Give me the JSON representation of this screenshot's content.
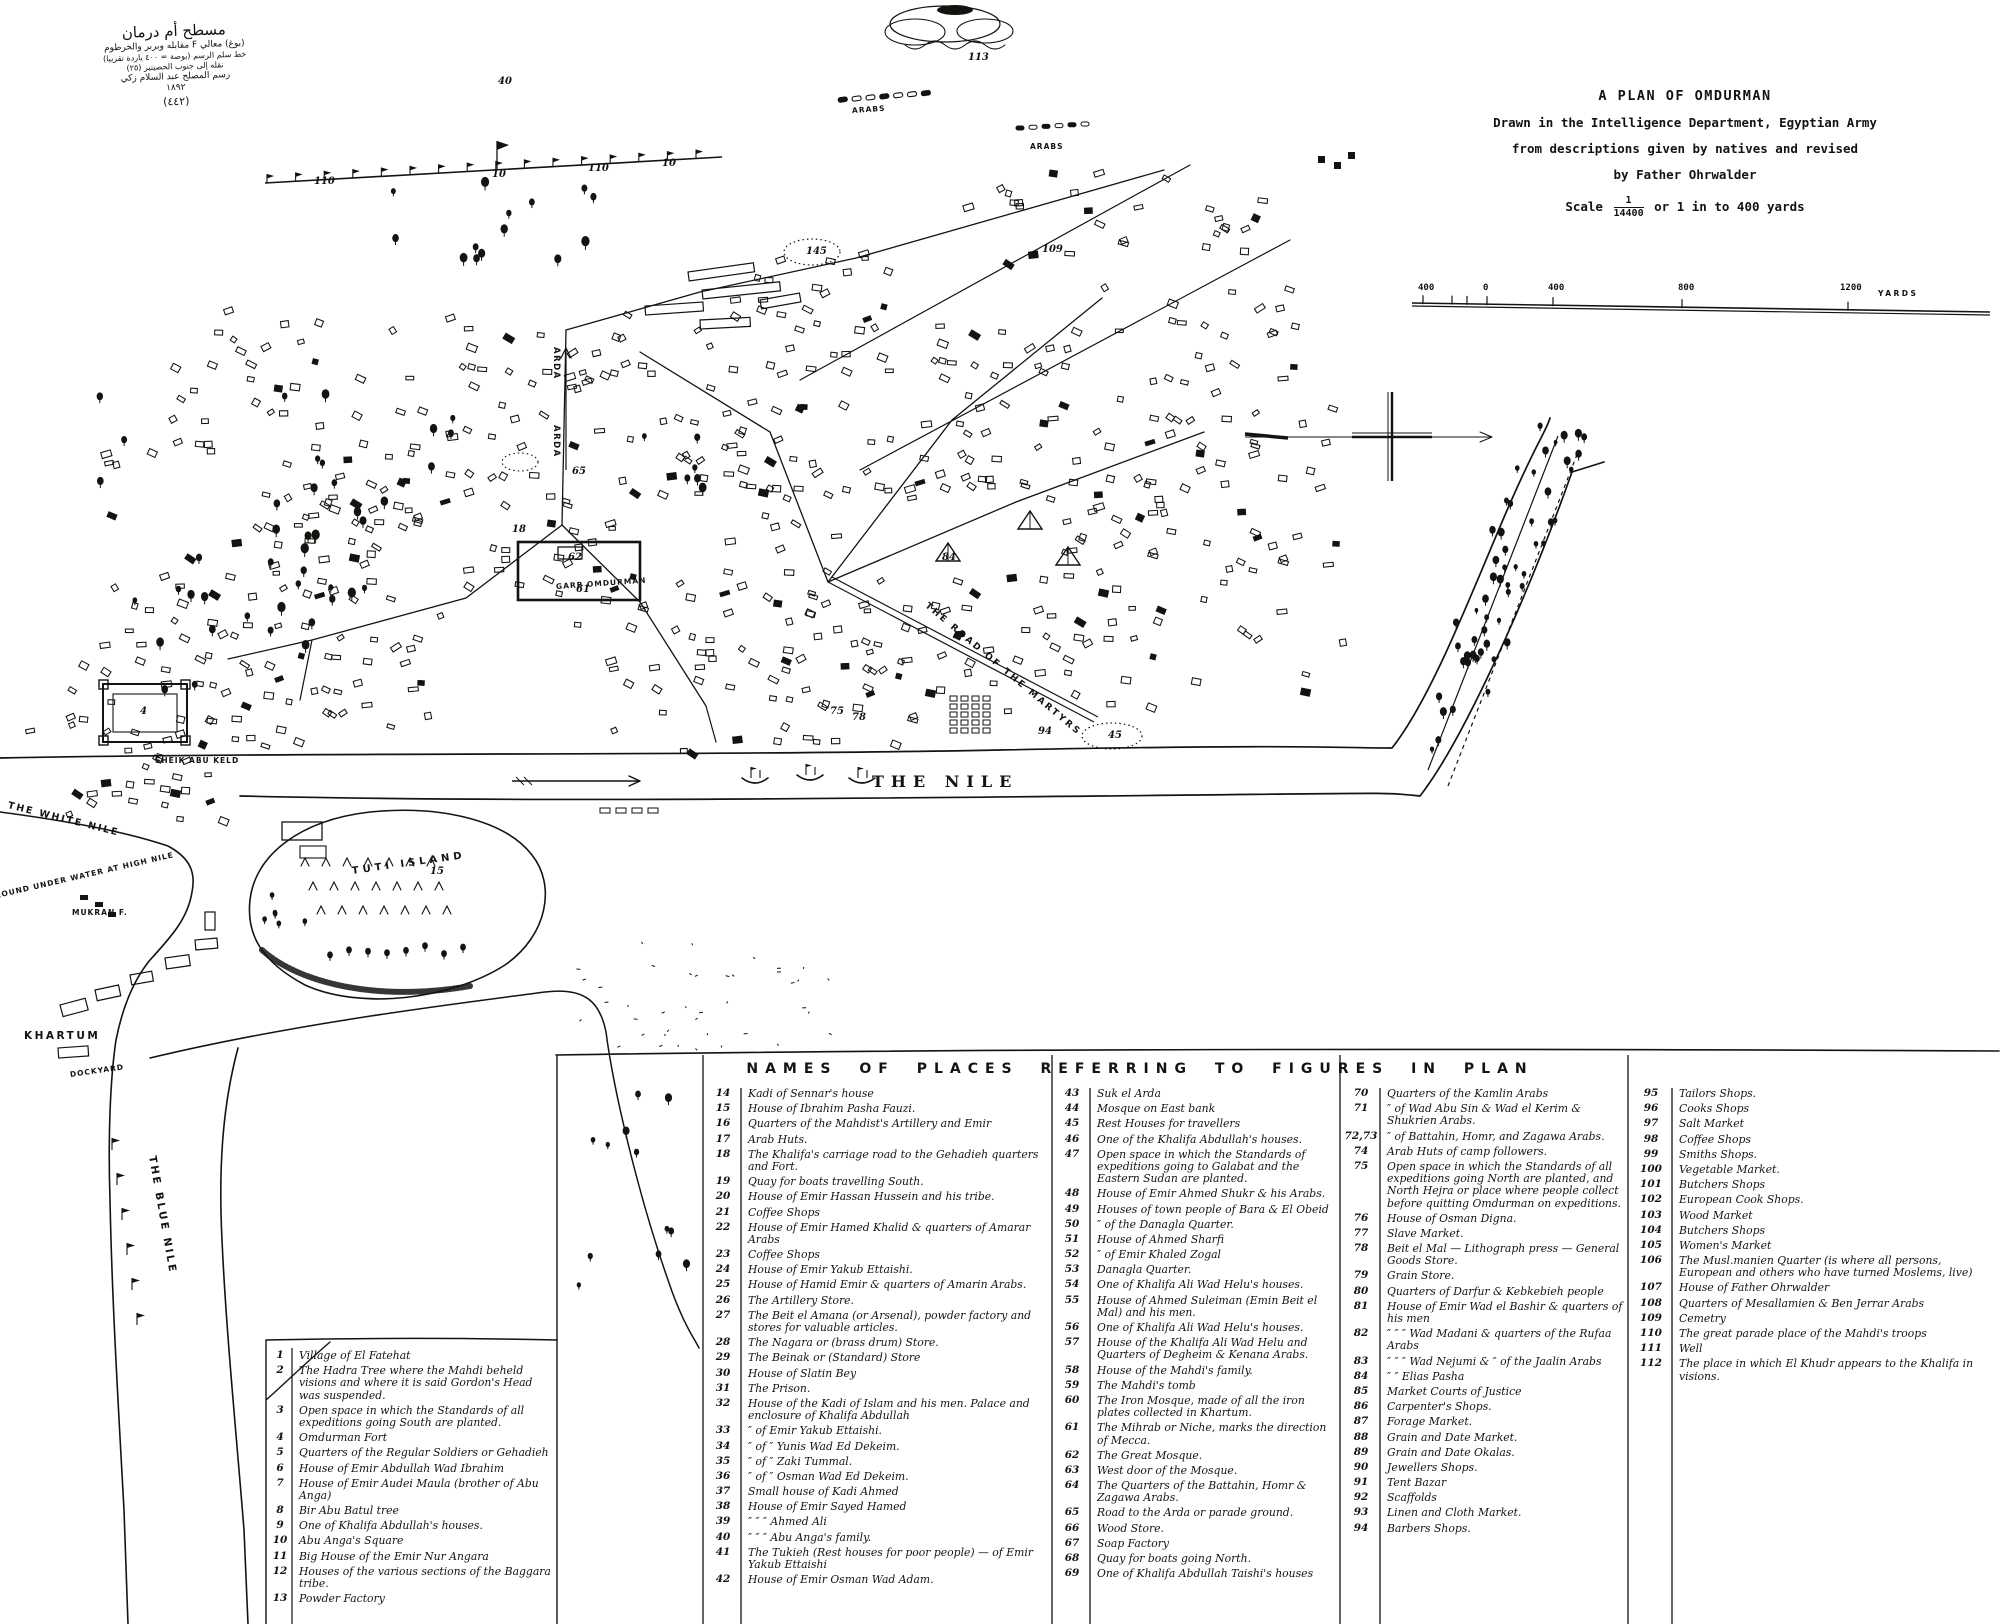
{
  "arabic_note": {
    "lines": [
      {
        "t": "مسطح أم درمان",
        "size": 15
      },
      {
        "t": "(بوغ) معالي F مقابله وبربر والخرطوم",
        "size": 9
      },
      {
        "t": "خط سلم الرسم (بوصة = ٤٠٠ ياردة تقريبا)",
        "size": 8
      },
      {
        "t": "نقله إلى جنوب الحصينير (٢٥)",
        "size": 8
      },
      {
        "t": "رسم المصلح عبد السلام زكي",
        "size": 9
      },
      {
        "t": "١٨٩٢",
        "size": 9
      },
      {
        "t": "(٤٤٢)",
        "size": 11
      }
    ]
  },
  "title_block": {
    "title": "A PLAN OF OMDURMAN",
    "line1": "Drawn in the Intelligence Department, Egyptian Army",
    "line2": "from descriptions given by natives and revised",
    "line3": "by Father Ohrwalder",
    "scale_label": "Scale",
    "scale_numerator": "1",
    "scale_denominator": "14400",
    "scale_suffix": "or 1 in to 400 yards"
  },
  "scale_bar": {
    "labels": [
      {
        "t": "400",
        "x": 1418
      },
      {
        "t": "0",
        "x": 1483
      },
      {
        "t": "400",
        "x": 1548
      },
      {
        "t": "800",
        "x": 1678
      },
      {
        "t": "1200",
        "x": 1840
      }
    ],
    "unit": "YARDS"
  },
  "map_labels": [
    {
      "id": "the-nile",
      "text": "THE NILE",
      "x": 872,
      "y": 772,
      "rot": 0,
      "cls": "lbl-xl"
    },
    {
      "id": "white-nile",
      "text": "THE WHITE NILE",
      "x": 8,
      "y": 800,
      "rot": 14,
      "cls": "lbl-sm"
    },
    {
      "id": "ground-under-water",
      "text": "GROUND UNDER WATER AT HIGH NILE",
      "x": -12,
      "y": 893,
      "rot": -13,
      "cls": "lbl-xxs"
    },
    {
      "id": "blue-nile",
      "text": "THE BLUE NILE",
      "x": 152,
      "y": 1150,
      "rot": 80,
      "cls": "lbl-md"
    },
    {
      "id": "khartum",
      "text": "KHARTUM",
      "x": 24,
      "y": 1030,
      "rot": 0,
      "cls": "lbl-md"
    },
    {
      "id": "dockyard",
      "text": "DOCKYARD",
      "x": 70,
      "y": 1070,
      "rot": -8,
      "cls": "lbl-xxs"
    },
    {
      "id": "mukran-f",
      "text": "MUKRAN F.",
      "x": 72,
      "y": 908,
      "rot": 0,
      "cls": "lbl-xxs"
    },
    {
      "id": "sheik-abu-keld",
      "text": "SHEIK ABU KELD",
      "x": 155,
      "y": 756,
      "rot": 0,
      "cls": "lbl-xxs"
    },
    {
      "id": "tuti-island",
      "text": "TUTI  ISLAND",
      "x": 352,
      "y": 866,
      "rot": -8,
      "cls": "lbl-md-sp"
    },
    {
      "id": "garb-omdurman",
      "text": "GARB OMDURMAN",
      "x": 556,
      "y": 582,
      "rot": -4,
      "cls": "lbl-xxs"
    },
    {
      "id": "road-of-martyrs",
      "text": "THE ROAD OF THE MARTYRS",
      "x": 926,
      "y": 600,
      "rot": 40,
      "cls": "lbl-xs-sp"
    },
    {
      "id": "arda-upper",
      "text": "ARDA",
      "x": 556,
      "y": 342,
      "rot": 90,
      "cls": "lbl-xs"
    },
    {
      "id": "arda-lower",
      "text": "ARDA",
      "x": 556,
      "y": 420,
      "rot": 90,
      "cls": "lbl-xs"
    },
    {
      "id": "arabs-1",
      "text": "ARABS",
      "x": 852,
      "y": 106,
      "rot": -4,
      "cls": "lbl-xxs"
    },
    {
      "id": "arabs-2",
      "text": "ARABS",
      "x": 1030,
      "y": 142,
      "rot": 0,
      "cls": "lbl-xxs"
    }
  ],
  "figure_markers": [
    {
      "n": "113",
      "x": 968,
      "y": 52
    },
    {
      "n": "40",
      "x": 498,
      "y": 76
    },
    {
      "n": "110",
      "x": 314,
      "y": 176
    },
    {
      "n": "10",
      "x": 492,
      "y": 169
    },
    {
      "n": "110",
      "x": 588,
      "y": 163
    },
    {
      "n": "10",
      "x": 662,
      "y": 158
    },
    {
      "n": "145",
      "x": 806,
      "y": 246
    },
    {
      "n": "109",
      "x": 1042,
      "y": 244
    },
    {
      "n": "65",
      "x": 572,
      "y": 466
    },
    {
      "n": "62",
      "x": 568,
      "y": 552
    },
    {
      "n": "61",
      "x": 576,
      "y": 584
    },
    {
      "n": "18",
      "x": 512,
      "y": 524
    },
    {
      "n": "4",
      "x": 140,
      "y": 706
    },
    {
      "n": "84",
      "x": 942,
      "y": 552
    },
    {
      "n": "75",
      "x": 830,
      "y": 706
    },
    {
      "n": "78",
      "x": 852,
      "y": 712
    },
    {
      "n": "94",
      "x": 1038,
      "y": 726
    },
    {
      "n": "45",
      "x": 1108,
      "y": 730
    },
    {
      "n": "15",
      "x": 430,
      "y": 866
    }
  ],
  "legend": {
    "header": "NAMES OF PLACES REFERRING TO FIGURES IN PLAN",
    "columns": [
      {
        "entries": [
          {
            "n": "1",
            "t": "Village of El Fatehat"
          },
          {
            "n": "2",
            "t": "The Hadra Tree where the Mahdi beheld visions and where it is said Gordon's Head was suspended."
          },
          {
            "n": "3",
            "t": "Open space in which the Standards of all expeditions going South are planted."
          },
          {
            "n": "4",
            "t": "Omdurman Fort"
          },
          {
            "n": "5",
            "t": "Quarters of the Regular Soldiers or Gehadieh"
          },
          {
            "n": "6",
            "t": "House of Emir Abdullah Wad Ibrahim"
          },
          {
            "n": "7",
            "t": "House of Emir Audei Maula (brother of Abu Anga)"
          },
          {
            "n": "8",
            "t": "Bir Abu Batul tree"
          },
          {
            "n": "9",
            "t": "One of Khalifa Abdullah's houses."
          },
          {
            "n": "10",
            "t": "Abu Anga's Square"
          },
          {
            "n": "11",
            "t": "Big House of the Emir Nur Angara"
          },
          {
            "n": "12",
            "t": "Houses of the various sections of the Baggara tribe."
          },
          {
            "n": "13",
            "t": "Powder Factory"
          }
        ]
      },
      {
        "entries": [
          {
            "n": "14",
            "t": "Kadi of Sennar's house"
          },
          {
            "n": "15",
            "t": "House of Ibrahim Pasha Fauzi."
          },
          {
            "n": "16",
            "t": "Quarters of the Mahdist's Artillery and Emir"
          },
          {
            "n": "17",
            "t": "Arab Huts."
          },
          {
            "n": "18",
            "t": "The Khalifa's carriage road to the Gehadieh quarters and Fort."
          },
          {
            "n": "19",
            "t": "Quay for boats travelling South."
          },
          {
            "n": "20",
            "t": "House of Emir Hassan Hussein and his tribe."
          },
          {
            "n": "21",
            "t": "Coffee Shops"
          },
          {
            "n": "22",
            "t": "House of Emir Hamed Khalid & quarters of Amarar Arabs"
          },
          {
            "n": "23",
            "t": "Coffee Shops"
          },
          {
            "n": "24",
            "t": "House of Emir Yakub Ettaishi."
          },
          {
            "n": "25",
            "t": "House of Hamid Emir & quarters of Amarin Arabs."
          },
          {
            "n": "26",
            "t": "The Artillery Store."
          },
          {
            "n": "27",
            "t": "The Beit el Amana (or Arsenal), powder factory and stores for valuable articles."
          },
          {
            "n": "28",
            "t": "The Nagara or (brass drum) Store."
          },
          {
            "n": "29",
            "t": "The Beinak or (Standard) Store"
          },
          {
            "n": "30",
            "t": "House of Slatin Bey"
          },
          {
            "n": "31",
            "t": "The Prison."
          },
          {
            "n": "32",
            "t": "House of the Kadi of Islam and his men. Palace and enclosure of Khalifa Abdullah"
          },
          {
            "n": "33",
            "t": "″ of Emir Yakub Ettaishi."
          },
          {
            "n": "34",
            "t": "″ of ″ Yunis Wad Ed Dekeim."
          },
          {
            "n": "35",
            "t": "″ of ″ Zaki Tummal."
          },
          {
            "n": "36",
            "t": "″ of ″ Osman Wad Ed Dekeim."
          },
          {
            "n": "37",
            "t": "Small house of Kadi Ahmed"
          },
          {
            "n": "38",
            "t": "House of Emir Sayed Hamed"
          },
          {
            "n": "39",
            "t": "″ ″ ″ Ahmed Ali"
          },
          {
            "n": "40",
            "t": "″ ″ ″ Abu Anga's family."
          },
          {
            "n": "41",
            "t": "The Tukieh (Rest houses for poor people) — of Emir Yakub Ettaishi"
          },
          {
            "n": "42",
            "t": "House of Emir Osman Wad Adam."
          }
        ]
      },
      {
        "entries": [
          {
            "n": "43",
            "t": "Suk el Arda"
          },
          {
            "n": "44",
            "t": "Mosque on East bank"
          },
          {
            "n": "45",
            "t": "Rest Houses for travellers"
          },
          {
            "n": "46",
            "t": "One of the Khalifa Abdullah's houses."
          },
          {
            "n": "47",
            "t": "Open space in which the Standards of expeditions going to Galabat and the Eastern Sudan are planted."
          },
          {
            "n": "48",
            "t": "House of Emir Ahmed Shukr & his Arabs."
          },
          {
            "n": "49",
            "t": "Houses of town people of Bara & El Obeid"
          },
          {
            "n": "50",
            "t": "″ of the Danagla Quarter."
          },
          {
            "n": "51",
            "t": "House of Ahmed Sharfi"
          },
          {
            "n": "52",
            "t": "″ of Emir Khaled Zogal"
          },
          {
            "n": "53",
            "t": "Danagla Quarter."
          },
          {
            "n": "54",
            "t": "One of Khalifa Ali Wad Helu's houses."
          },
          {
            "n": "55",
            "t": "House of Ahmed Suleiman (Emin Beit el Mal) and his men."
          },
          {
            "n": "56",
            "t": "One of Khalifa Ali Wad Helu's houses."
          },
          {
            "n": "57",
            "t": "House of the Khalifa Ali Wad Helu and Quarters of Degheim & Kenana Arabs."
          },
          {
            "n": "58",
            "t": "House of the Mahdi's family."
          },
          {
            "n": "59",
            "t": "The Mahdi's tomb"
          },
          {
            "n": "60",
            "t": "The Iron Mosque, made of all the iron plates collected in Khartum."
          },
          {
            "n": "61",
            "t": "The Mihrab or Niche, marks the direction of Mecca."
          },
          {
            "n": "62",
            "t": "The Great Mosque."
          },
          {
            "n": "63",
            "t": "West door of the Mosque."
          },
          {
            "n": "64",
            "t": "The Quarters of the Battahin, Homr & Zagawa Arabs."
          },
          {
            "n": "65",
            "t": "Road to the Arda or parade ground."
          },
          {
            "n": "66",
            "t": "Wood Store."
          },
          {
            "n": "67",
            "t": "Soap Factory"
          },
          {
            "n": "68",
            "t": "Quay for boats going North."
          },
          {
            "n": "69",
            "t": "One of Khalifa Abdullah Taishi's houses"
          }
        ]
      },
      {
        "entries": [
          {
            "n": "70",
            "t": "Quarters of the Kamlin Arabs"
          },
          {
            "n": "71",
            "t": "″ of Wad Abu Sin & Wad el Kerim & Shukrien Arabs."
          },
          {
            "n": "72,73",
            "t": "″ of Battahin, Homr, and Zagawa Arabs."
          },
          {
            "n": "74",
            "t": "Arab Huts of camp followers."
          },
          {
            "n": "75",
            "t": "Open space in which the Standards of all expeditions going North are planted, and North Hejra or place where people collect before quitting Omdurman on expeditions."
          },
          {
            "n": "76",
            "t": "House of Osman Digna."
          },
          {
            "n": "77",
            "t": "Slave Market."
          },
          {
            "n": "78",
            "t": "Beit el Mal — Lithograph press — General Goods Store."
          },
          {
            "n": "79",
            "t": "Grain Store."
          },
          {
            "n": "80",
            "t": "Quarters of Darfur & Kebkebieh people"
          },
          {
            "n": "81",
            "t": "House of Emir Wad el Bashir & quarters of his men"
          },
          {
            "n": "82",
            "t": "″ ″ ″ Wad Madani & quarters of the Rufaa Arabs"
          },
          {
            "n": "83",
            "t": "″ ″ ″ Wad Nejumi & ″ of the Jaalin Arabs"
          },
          {
            "n": "84",
            "t": "″ ″ Elias Pasha"
          },
          {
            "n": "85",
            "t": "Market Courts of Justice"
          },
          {
            "n": "86",
            "t": "Carpenter's Shops."
          },
          {
            "n": "87",
            "t": "Forage Market."
          },
          {
            "n": "88",
            "t": "Grain and Date Market."
          },
          {
            "n": "89",
            "t": "Grain and Date Okalas."
          },
          {
            "n": "90",
            "t": "Jewellers Shops."
          },
          {
            "n": "91",
            "t": "Tent Bazar"
          },
          {
            "n": "92",
            "t": "Scaffolds"
          },
          {
            "n": "93",
            "t": "Linen and Cloth Market."
          },
          {
            "n": "94",
            "t": "Barbers Shops."
          }
        ]
      },
      {
        "entries": [
          {
            "n": "95",
            "t": "Tailors Shops."
          },
          {
            "n": "96",
            "t": "Cooks Shops"
          },
          {
            "n": "97",
            "t": "Salt Market"
          },
          {
            "n": "98",
            "t": "Coffee Shops"
          },
          {
            "n": "99",
            "t": "Smiths Shops."
          },
          {
            "n": "100",
            "t": "Vegetable Market."
          },
          {
            "n": "101",
            "t": "Butchers Shops"
          },
          {
            "n": "102",
            "t": "European Cook Shops."
          },
          {
            "n": "103",
            "t": "Wood Market"
          },
          {
            "n": "104",
            "t": "Butchers Shops"
          },
          {
            "n": "105",
            "t": "Women's Market"
          },
          {
            "n": "106",
            "t": "The Musl.manien Quarter (is where all persons, European and others who have turned Moslems, live)"
          },
          {
            "n": "107",
            "t": "House of Father Ohrwalder"
          },
          {
            "n": "108",
            "t": "Quarters of Mesallamien & Ben Jerrar Arabs"
          },
          {
            "n": "109",
            "t": "Cemetry"
          },
          {
            "n": "110",
            "t": "The great parade place of the Mahdi's troops"
          },
          {
            "n": "111",
            "t": "Well"
          },
          {
            "n": "112",
            "t": "The place in which El Khudr appears to the Khalifa in visions."
          }
        ]
      }
    ]
  }
}
